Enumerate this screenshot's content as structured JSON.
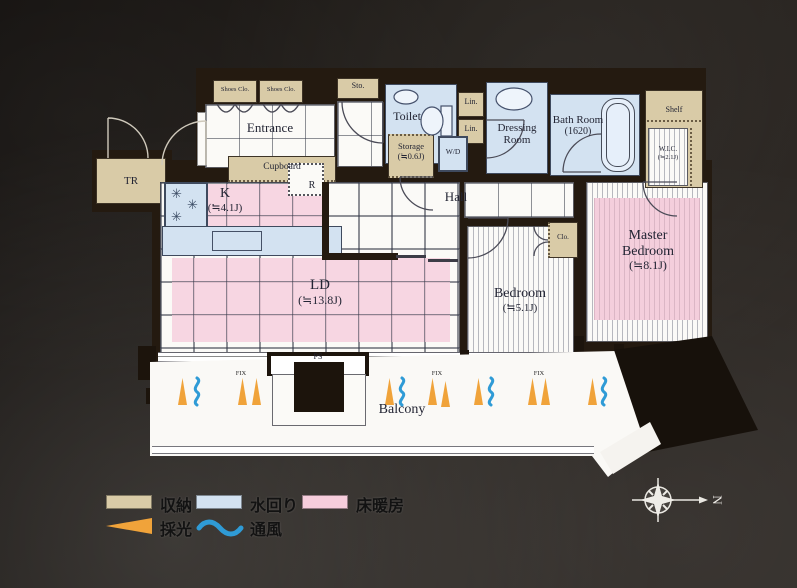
{
  "rooms": {
    "entrance": {
      "label": "Entrance"
    },
    "kitchen": {
      "label": "K",
      "size": "(≒4.1J)"
    },
    "living": {
      "label": "LD",
      "size": "(≒13.8J)"
    },
    "hall": {
      "label": "Hall"
    },
    "bedroom": {
      "label": "Bedroom",
      "size": "(≒5.1J)"
    },
    "master_bedroom": {
      "label_1": "Master",
      "label_2": "Bedroom",
      "size": "(≒8.1J)"
    },
    "toilet": {
      "label": "Toilet"
    },
    "dressing": {
      "label_1": "Dressing",
      "label_2": "Room"
    },
    "bath": {
      "label": "Bath Room",
      "size": "(1620)"
    },
    "storage": {
      "label": "Storage",
      "size": "(≒0.6J)"
    },
    "wic": {
      "label": "W.I.C.",
      "size": "(≒2.1J)"
    },
    "balcony": {
      "label": "Balcony"
    }
  },
  "fixtures": {
    "shoes_closet_1": "Shoes Clo.",
    "shoes_closet_2": "Shoes Clo.",
    "sto": "Sto.",
    "cupboard": "Cupboard",
    "refrigerator": "R",
    "lin_1": "Lin.",
    "lin_2": "Lin.",
    "washer_dryer": "W/D",
    "closet": "Clo.",
    "shelf": "Shelf",
    "trunk_room": "TR",
    "pipe_space": "PS",
    "fix_window": "FIX",
    "burner_icon": "✳"
  },
  "legend": {
    "items": [
      {
        "key": "storage",
        "label": "収納"
      },
      {
        "key": "water",
        "label": "水回り"
      },
      {
        "key": "floor_heating",
        "label": "床暖房"
      },
      {
        "key": "daylight",
        "label": "採光"
      },
      {
        "key": "ventilation",
        "label": "通風"
      }
    ]
  },
  "compass": {
    "north": "N"
  },
  "colors": {
    "storage": "#d9cba7",
    "water": "#d3e2f1",
    "floor_heating": "#f6cddc",
    "daylight": "#f0a33a",
    "ventilation": "#2f9bd6",
    "wall": "#241a10",
    "background": "#221e1a"
  }
}
